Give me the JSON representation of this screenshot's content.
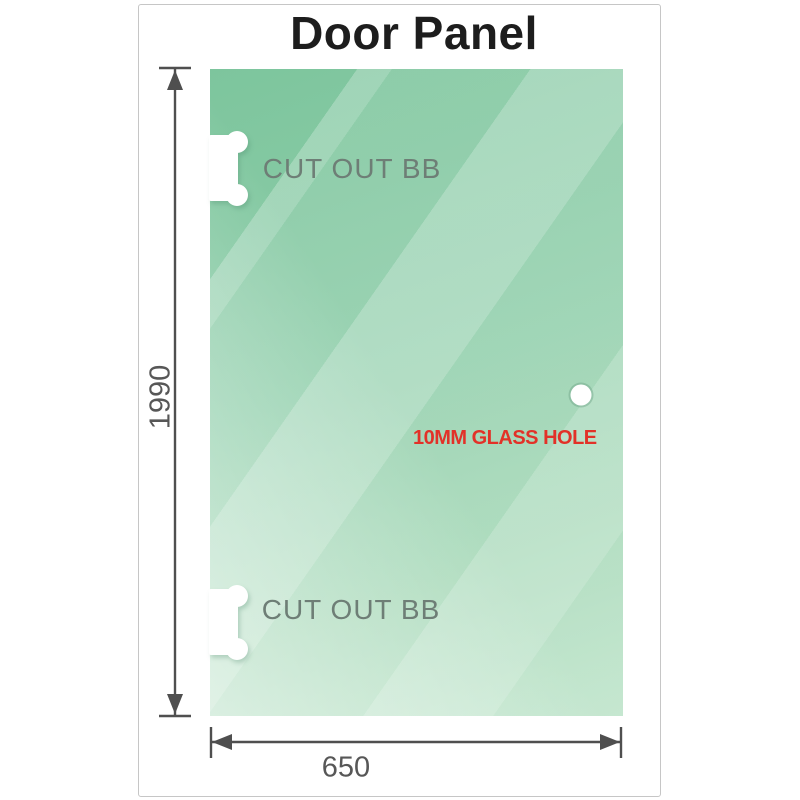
{
  "title": "Door Panel",
  "panel": {
    "cutouts": [
      {
        "label": "CUT OUT BB"
      },
      {
        "label": "CUT OUT BB"
      }
    ],
    "hole": {
      "label": "10MM GLASS HOLE"
    }
  },
  "dimensions": {
    "height": "1990",
    "width": "650"
  },
  "colors": {
    "glass_green_dark": "#7dc59d",
    "glass_green_light": "#b9e2c6",
    "dimension_gray": "#4f4f4f",
    "cutout_label_gray": "#6e7e76",
    "hole_label_red": "#e23128",
    "title_color": "#1d1d1d",
    "card_border": "#c6c6c6"
  }
}
